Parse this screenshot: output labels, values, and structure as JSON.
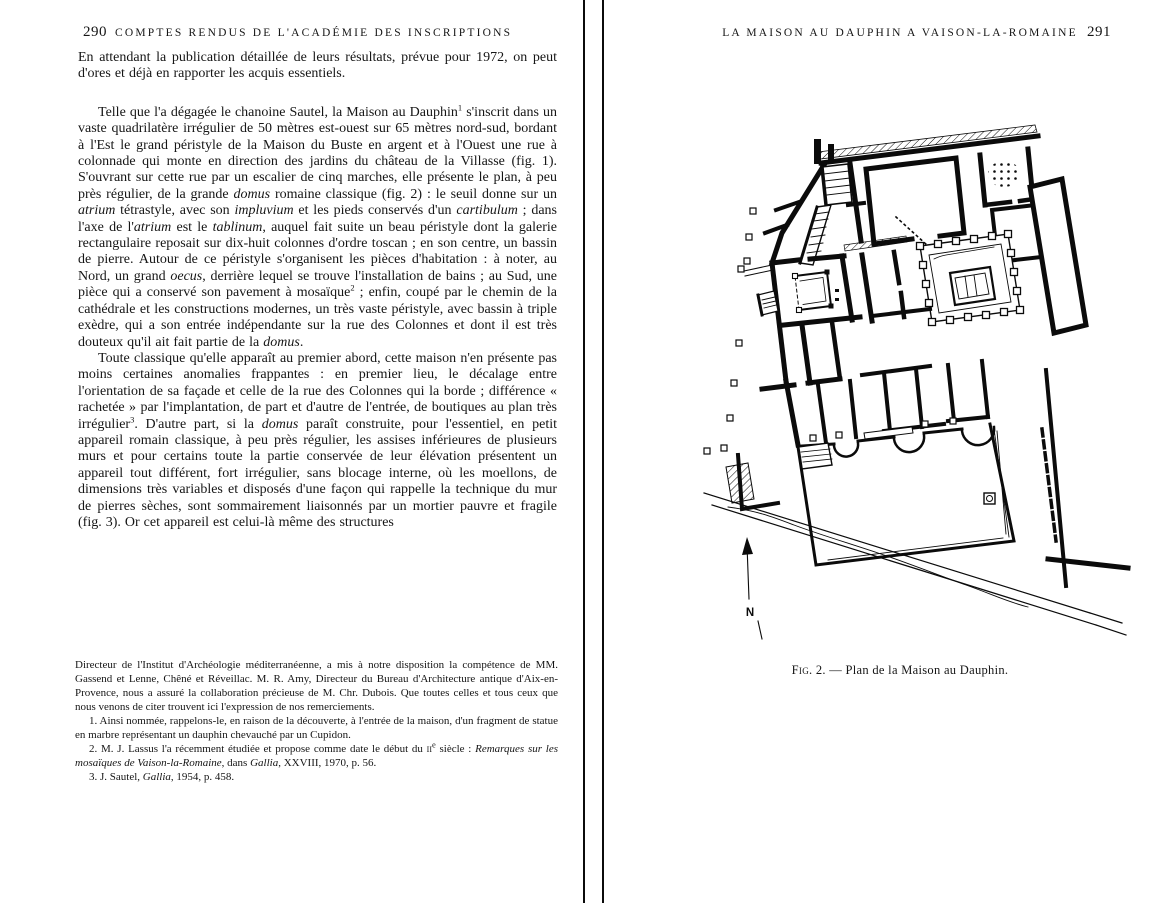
{
  "left_page": {
    "page_number": "290",
    "running_header": "COMPTES RENDUS DE L'ACADÉMIE DES INSCRIPTIONS",
    "paragraphs": [
      {
        "segments": [
          {
            "t": "En attendant la publication détaillée de leurs résultats, prévue pour 1972, on peut d'ores et déjà en rapporter les acquis essentiels."
          }
        ]
      },
      {
        "segments": [
          {
            "t": "Telle que l'a dégagée le chanoine Sautel, la Maison au Dauphin"
          },
          {
            "t": "1",
            "sup": true
          },
          {
            "t": " s'inscrit dans un vaste quadrilatère irrégulier de 50 mètres est-ouest sur 65 mètres nord-sud, bordant à l'Est le grand péristyle de la Maison du Buste en argent et à l'Ouest une rue à colonnade qui monte en direction des jardins du château de la Villasse (fig. 1). S'ouvrant sur cette rue par un escalier de cinq marches, elle présente le plan, à peu près régulier, de la grande "
          },
          {
            "t": "domus",
            "i": true
          },
          {
            "t": " romaine classique (fig. 2) : le seuil donne sur un "
          },
          {
            "t": "atrium",
            "i": true
          },
          {
            "t": " tétrastyle, avec son "
          },
          {
            "t": "impluvium",
            "i": true
          },
          {
            "t": " et les pieds conservés d'un "
          },
          {
            "t": "cartibulum",
            "i": true
          },
          {
            "t": " ; dans l'axe de l'"
          },
          {
            "t": "atrium",
            "i": true
          },
          {
            "t": " est le "
          },
          {
            "t": "tablinum",
            "i": true
          },
          {
            "t": ", auquel fait suite un beau péristyle dont la galerie rectangulaire reposait sur dix-huit colonnes d'ordre toscan ; en son centre, un bassin de pierre. Autour de ce péristyle s'organisent les pièces d'habitation : à noter, au Nord, un grand "
          },
          {
            "t": "oecus",
            "i": true
          },
          {
            "t": ", derrière lequel se trouve l'installation de bains ; au Sud, une pièce qui a conservé son pavement à mosaïque"
          },
          {
            "t": "2",
            "sup": true
          },
          {
            "t": " ; enfin, coupé par le chemin de la cathédrale et les constructions modernes, un très vaste péristyle, avec bassin à triple exèdre, qui a son entrée indépendante sur la rue des Colonnes et dont il est très douteux qu'il ait fait partie de la "
          },
          {
            "t": "domus",
            "i": true
          },
          {
            "t": "."
          }
        ]
      },
      {
        "segments": [
          {
            "t": "Toute classique qu'elle apparaît au premier abord, cette maison n'en présente pas moins certaines anomalies frappantes : en premier lieu, le décalage entre l'orientation de sa façade et celle de la rue des Colonnes qui la borde ; différence « rachetée » par l'implantation, de part et d'autre de l'entrée, de boutiques au plan très irrégulier"
          },
          {
            "t": "3",
            "sup": true
          },
          {
            "t": ". D'autre part, si la "
          },
          {
            "t": "domus",
            "i": true
          },
          {
            "t": " paraît construite, pour l'essentiel, en petit appareil romain classique, à peu près régulier, les assises inférieures de plusieurs murs et pour certains toute la partie conservée de leur élévation présentent un appareil tout différent, fort irrégulier, sans blocage interne, où les moellons, de dimensions très variables et disposés d'une façon qui rappelle la technique du mur de pierres sèches, sont sommairement liaisonnés par un mortier pauvre et fragile (fig. 3). Or cet appareil est celui-là même des structures"
          }
        ]
      }
    ],
    "footnotes": [
      {
        "segments": [
          {
            "t": "Directeur de l'Institut d'Archéologie méditerranéenne, a mis à notre disposition la compétence de MM. Gassend et Lenne, Chêné et Réveillac. M. R. Amy, Directeur du Bureau d'Architecture antique d'Aix-en-Provence, nous a assuré la collaboration précieuse de M. Chr. Dubois. Que toutes celles et tous ceux que nous venons de citer trouvent ici l'expression de nos remerciements."
          }
        ]
      },
      {
        "segments": [
          {
            "t": "1. Ainsi nommée, rappelons-le, en raison de la découverte, à l'entrée de la maison, d'un fragment de statue en marbre représentant un dauphin chevauché par un Cupidon."
          }
        ]
      },
      {
        "segments": [
          {
            "t": "2. M. J. Lassus l'a récemment étudiée et propose comme date le début du "
          },
          {
            "t": "ii",
            "sc": true
          },
          {
            "t": "e",
            "sup": true
          },
          {
            "t": " siècle : "
          },
          {
            "t": "Remarques sur les mosaïques de Vaison-la-Romaine",
            "i": true
          },
          {
            "t": ", dans "
          },
          {
            "t": "Gallia",
            "i": true
          },
          {
            "t": ", XXVIII, 1970, p. 56."
          }
        ]
      },
      {
        "segments": [
          {
            "t": "3. J. Sautel, "
          },
          {
            "t": "Gallia",
            "i": true
          },
          {
            "t": ", 1954, p. 458."
          }
        ]
      }
    ]
  },
  "right_page": {
    "running_header": "LA MAISON AU DAUPHIN A VAISON-LA-ROMAINE",
    "page_number": "291",
    "figure": {
      "caption_label": "Fig. 2.",
      "caption_separator": "—",
      "caption_text": "Plan de la Maison au Dauphin.",
      "north_label": "N"
    }
  }
}
